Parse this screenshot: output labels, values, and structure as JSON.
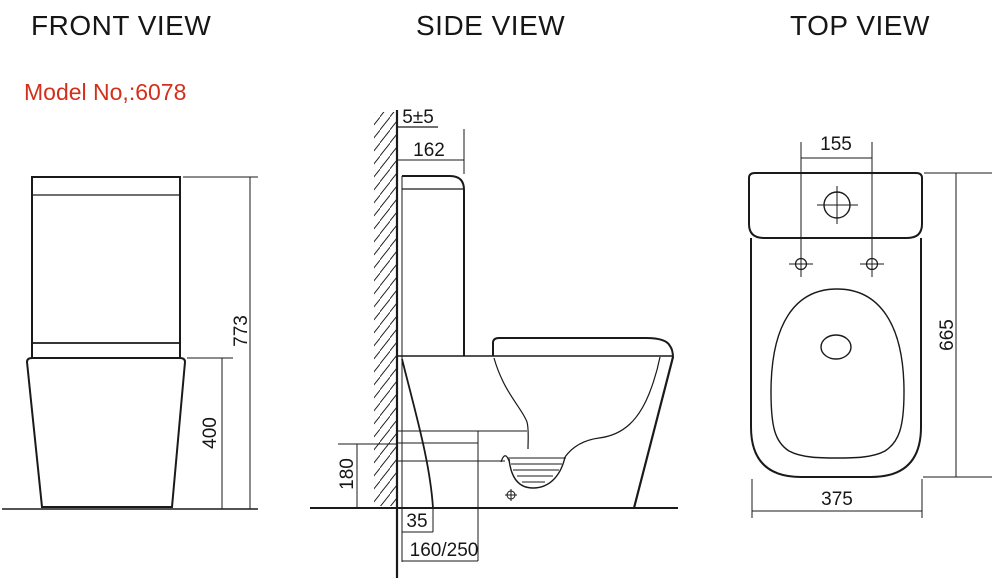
{
  "page": {
    "background": "#ffffff",
    "line_color": "#1a1a1a",
    "accent_red": "#d2301c"
  },
  "front_view": {
    "title": "FRONT VIEW",
    "model_label": "Model No,:6078",
    "dim_total_height": "773",
    "dim_base_height": "400"
  },
  "side_view": {
    "title": "SIDE VIEW",
    "dim_wall_gap": "5±5",
    "dim_tank_depth": "162",
    "dim_outlet_height": "180",
    "dim_outlet_offset": "35",
    "dim_rough_in": "160/250"
  },
  "top_view": {
    "title": "TOP VIEW",
    "dim_hole_spacing": "155",
    "dim_total_depth": "665",
    "dim_width": "375"
  }
}
